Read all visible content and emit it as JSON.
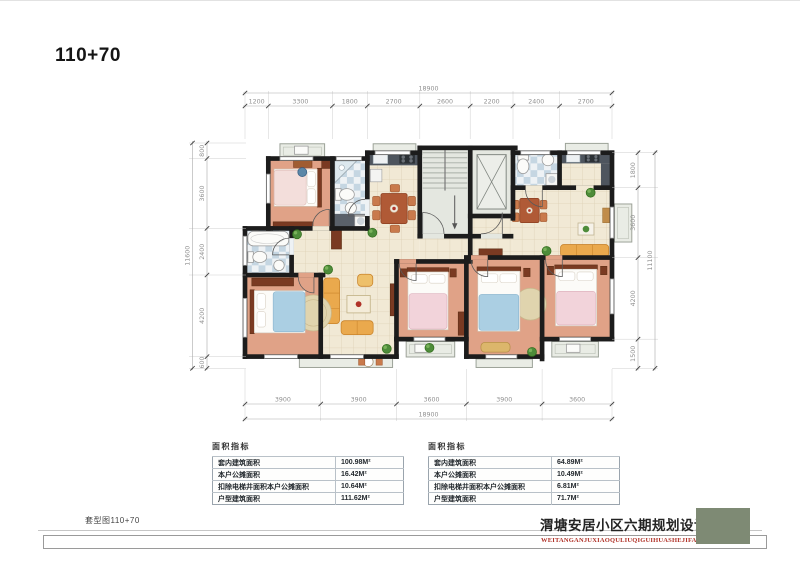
{
  "page": {
    "title": "110+70"
  },
  "plan": {
    "dim_top": {
      "total": "18900",
      "segments": [
        "1200",
        "3300",
        "1800",
        "2700",
        "2600",
        "2200",
        "2400",
        "2700"
      ]
    },
    "dim_bottom": {
      "total": "18900",
      "segments": [
        "3900",
        "3900",
        "3600",
        "3900",
        "3600"
      ]
    },
    "dim_left": {
      "total": "11600",
      "segments": [
        "800",
        "3600",
        "2400",
        "4200",
        "600"
      ]
    },
    "dim_right": {
      "total": "11100",
      "segments": [
        "1800",
        "3600",
        "4200",
        "1500"
      ]
    }
  },
  "tables": [
    {
      "title": "面积指标",
      "rows": [
        {
          "label": "套内建筑面积",
          "value": "100.98M²"
        },
        {
          "label": "本户公摊面积",
          "value": "16.42M²"
        },
        {
          "label": "扣除电梯井面积本户公摊面积",
          "value": "10.64M²"
        },
        {
          "label": "户型建筑面积",
          "value": "111.62M²"
        }
      ]
    },
    {
      "title": "面积指标",
      "rows": [
        {
          "label": "套内建筑面积",
          "value": "64.89M²"
        },
        {
          "label": "本户公摊面积",
          "value": "10.49M²"
        },
        {
          "label": "扣除电梯井面积本户公摊面积",
          "value": "6.81M²"
        },
        {
          "label": "户型建筑面积",
          "value": "71.7M²"
        }
      ]
    }
  ],
  "footer": {
    "sheet_label": "套型图110+70",
    "project_title": "渭塘安居小区六期规划设计方案",
    "project_subtitle": "WEITANGANJUXIAOQULIUQIGUIHUASHEJIFANG'AN"
  },
  "colors": {
    "wall": "#1c1c1c",
    "bedroom_floor": "#e0a287",
    "tile_floor": "#f1e9d5",
    "bath_tile": "#c5d6e2",
    "core_floor": "#e4e7e0",
    "balcony": "#e9ece5",
    "counter": "#4e555e",
    "sofa": "#eaa94d",
    "blanket_blue": "#abcfe3",
    "blanket_pink": "#f2d3da",
    "wood": "#7a3a22",
    "plant": "#4e8c3a",
    "dim_text": "#8f8f8f",
    "subtitle_red": "#b03228",
    "stamp_green": "#7e8a74"
  }
}
